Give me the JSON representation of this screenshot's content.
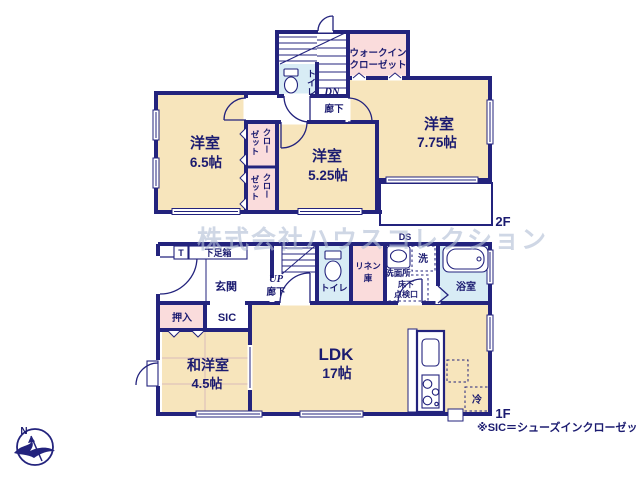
{
  "watermark": "株式会社ハウスコレクション",
  "compass": {
    "north": "N"
  },
  "colors": {
    "wall": "#23237d",
    "room_beige": "#f7e5bc",
    "closet_pink": "#fadcdc",
    "wet_blue": "#d8ecf5",
    "text_navy": "#1b1b70",
    "watermark_gray": "#b3bfd6"
  },
  "floor2": {
    "label": "2F",
    "room_65_name": "洋室",
    "room_65_size": "6.5帖",
    "room_525_name": "洋室",
    "room_525_size": "5.25帖",
    "room_775_name": "洋室",
    "room_775_size": "7.75帖",
    "wic_line1": "ウォークイン",
    "wic_line2": "クローゼット",
    "closet_top_col1": "クロー",
    "closet_top_col2": "ゼット",
    "closet_bottom_col1": "クロー",
    "closet_bottom_col2": "ゼット",
    "toilet": "トイレ",
    "hallway": "廊下",
    "stairs_down": "DN"
  },
  "floor1": {
    "label": "1F",
    "note": "※SIC＝シューズインクローゼット",
    "genkan": "玄関",
    "shoe_t": "T",
    "shoe_box": "下足箱",
    "sic": "SIC",
    "oshiire": "押入",
    "washitsu_name": "和洋室",
    "washitsu_size": "4.5帖",
    "ldk_name": "LDK",
    "ldk_size": "17帖",
    "stairs_up": "UP",
    "hallway": "廊下",
    "toilet": "トイレ",
    "linen_line1": "リネン",
    "linen_line2": "庫",
    "washroom": "洗面所",
    "washer": "洗",
    "hatch_line1": "床下",
    "hatch_line2": "点検口",
    "bath": "浴室",
    "fridge": "冷",
    "duct": "DS"
  }
}
